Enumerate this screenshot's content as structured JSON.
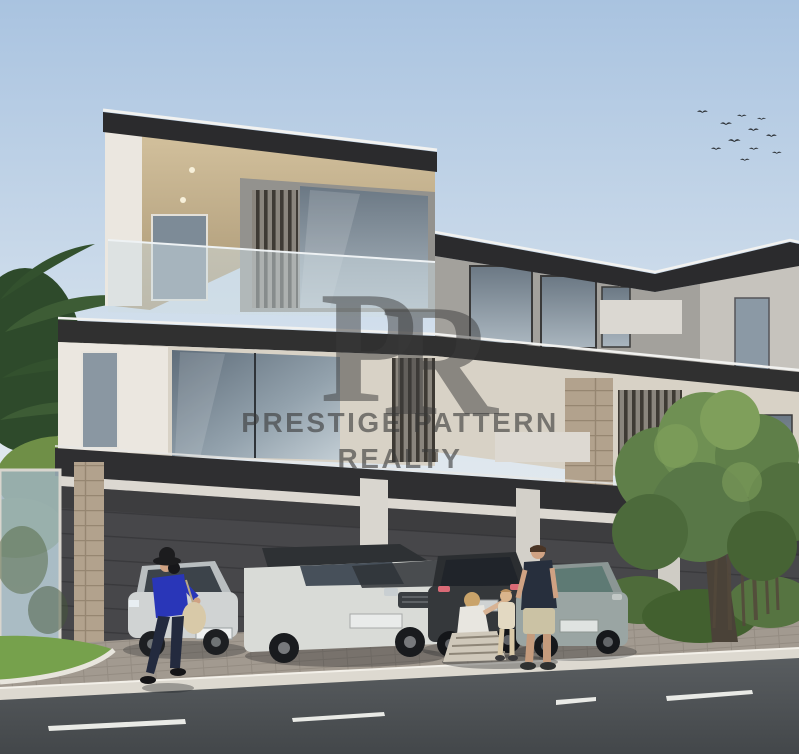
{
  "image": {
    "alt": "Rendering of a modern three-storey villa: carport with four parked cars, a family standing on the driveway, a woman walking with a bag, palm trees at left, a round-canopy tree at right, birds in the sky and an asphalt road with dashed lane markings in the foreground"
  },
  "watermark": {
    "monogram_p": "P",
    "monogram_r": "R",
    "line1": "PRESTIGE PATTERN",
    "line2": "REALTY"
  },
  "colors": {
    "sky_top": "#a9c3e0",
    "sky_mid": "#dce6ef",
    "sky_low": "#efeeea",
    "roof": "#2b2b2d",
    "roof_rim": "#f2f2f0",
    "soffit_light": "#d3c19d",
    "soffit_dark": "#a99674",
    "wall_white": "#ebe7e0",
    "wall_beige": "#d8d2c6",
    "wall_gray": "#a3a19c",
    "glass_dark": "#5f6d7a",
    "glass_light": "#c2cdd4",
    "fascia": "#2f2f31",
    "garage": "#47474a",
    "stone": "#b2a28d",
    "paver": "#a29a90",
    "curb": "#ddd9d0",
    "road": "#43474a",
    "lane_mark": "#e9eae6",
    "grass": "#76a14c",
    "tree": "#5f7f49",
    "tree_dark": "#42602f",
    "palm": "#3d5c35",
    "trunk": "#4a4238",
    "car_silver": "#d0d3d3",
    "car_white": "#d9dbd7",
    "car_dark": "#35383b",
    "car_gray": "#9aa5a3",
    "shirt_blue": "#2936b8",
    "shirt_navy": "#272f3d",
    "shorts_khaki": "#cbc2a4",
    "skin": "#cfa283",
    "bag": "#d8c9a8",
    "watermark": "#3a3a3a"
  }
}
